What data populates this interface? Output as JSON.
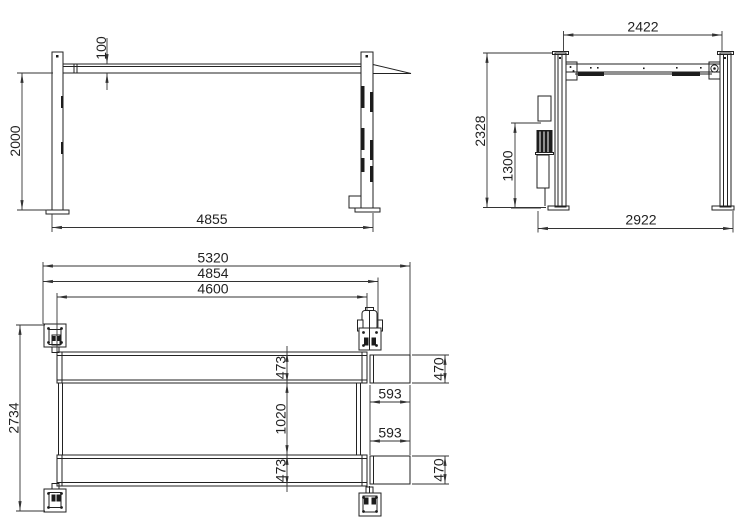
{
  "views": {
    "side": {
      "dims": {
        "lift_height": "2000",
        "platform_thickness": "100",
        "post_span_length": "4855"
      }
    },
    "end": {
      "dims": {
        "crossbeam_span": "2422",
        "overall_height": "2328",
        "power_unit_height": "1300",
        "overall_width": "2922"
      }
    },
    "plan": {
      "dims": {
        "overall_length": "5320",
        "post_span_length": "4854",
        "runway_length": "4600",
        "overall_width": "2734",
        "runway_width_top": "473",
        "runway_gap": "1020",
        "runway_width_bottom": "473",
        "ramp_offset_top": "593",
        "ramp_offset_bottom": "593",
        "ramp_width_top": "470",
        "ramp_width_bottom": "470"
      }
    }
  },
  "colors": {
    "background": "#ffffff",
    "line": "#222222",
    "dim_line": "#333333",
    "text": "#222222",
    "dark_fill": "#1c1c1c"
  }
}
